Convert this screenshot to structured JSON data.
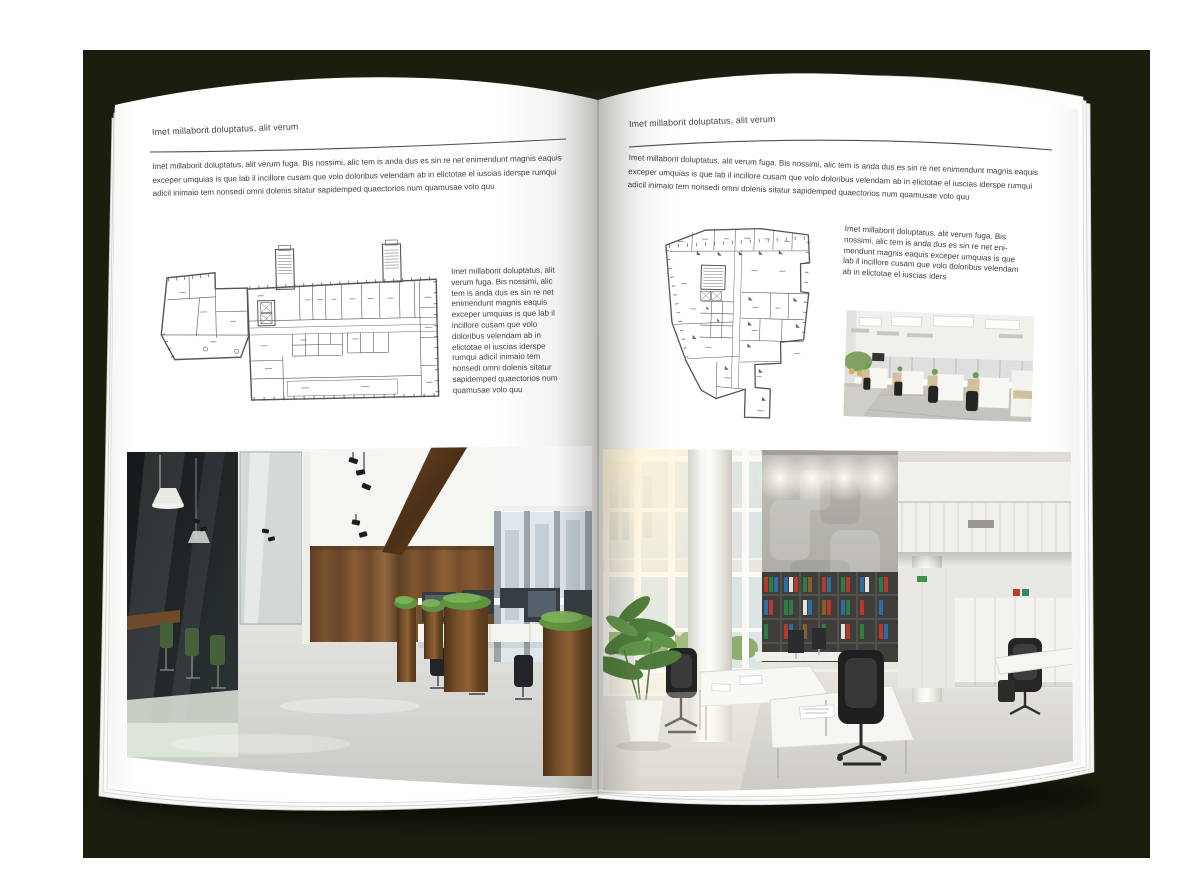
{
  "colors": {
    "backdrop": "#1b1d0e",
    "page": "#ffffff",
    "text": "#3e3e3e",
    "rule": "#4f4f4f"
  },
  "book": {
    "left_page": {
      "header": "Imet millaborit doluptatus, alit verum",
      "intro": "Imet millaborit doluptatus, alit verum fuga. Bis nossimi, alic tem is anda dus es sin re net enimendunt magnis eaquis exceper umquias is que lab il incillore cusam que volo doloribus velendam ab in elictotae el iuscias iderspe rumqui adicil inimaio tem nonsedi omni dolenis sitatur sapidemped quaectorios num quamusae volo quu",
      "caption": "Imet millaborit doluptatus, alit verum fuga. Bis nossimi, alic tem is anda dus es sin re net enimendunt magnis eaquis exceper umquias is que lab il incillore cusam que volo doloribus velendam ab in elictotae el iuscias iderspe rumqui adicil inimaio tem nonsedi omni dolenis sitatur sapidemped quaectorios num quamusae volo quu"
    },
    "right_page": {
      "header": "Imet millaborit doluptatus, alit verum",
      "intro": "Imet millaborit doluptatus, alit verum fuga. Bis nossimi, alic tem is anda dus es sin re net enimendunt magnis eaquis exceper umquias is que lab il incillore cusam que volo doloribus velendam ab in elictotae el iuscias iderspe rumqui adicil inimaio tem nonsedi omni dolenis sitatur sapidemped quaectorios num quamusae volo quu",
      "caption": "Imet millaborit doluptatus, alit verum fuga. Bis nossimi, alic tem is anda dus es sin re net eni-mendunt magnis eaquis exceper umquias is que lab il incillore cusam que volo doloribus velendam ab in elictotae el iuscias iders"
    }
  }
}
